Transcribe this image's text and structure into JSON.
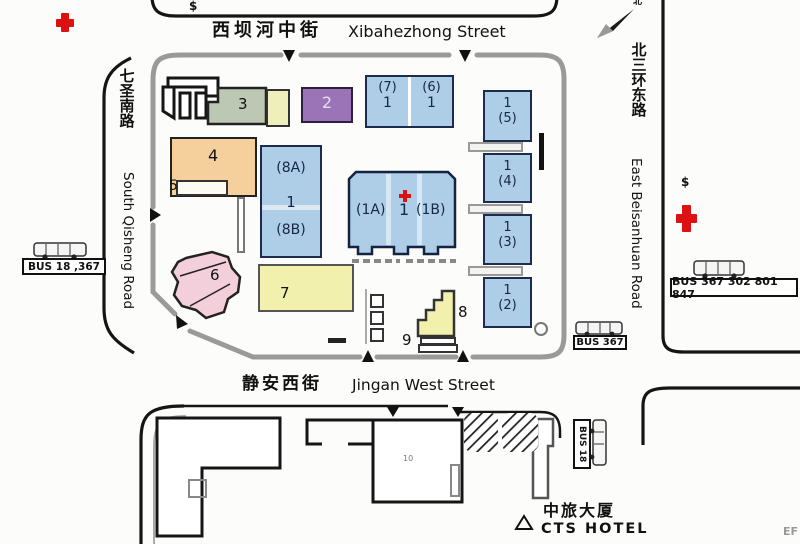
{
  "streets": {
    "north_zh": "西坝河中街",
    "north_en": "Xibahezhong Street",
    "south_zh": "静安西街",
    "south_en": "Jingan West Street",
    "west_zh": "七圣南路",
    "west_en": "South Qisheng Road",
    "east_zh": "北三环东路",
    "east_en": "East Beisanhuan Road"
  },
  "compass": {
    "north": "北"
  },
  "symbols": {
    "bank_top": "$",
    "bank_right": "$",
    "corner_mark": "EF"
  },
  "buildings": {
    "b1": {
      "left": "(1A)",
      "center": "1",
      "right": "(1B)"
    },
    "b2": "2",
    "b3": "3",
    "b4": "4",
    "b5": "5",
    "b6": "6",
    "b7": "7",
    "b8": "8",
    "b9": "9",
    "b10": "10",
    "b76": {
      "left_top": "(7)",
      "left_num": "1",
      "right_top": "(6)",
      "right_num": "1"
    },
    "b8ab": {
      "top": "(8A)",
      "num": "1",
      "bottom": "(8B)"
    },
    "t5": {
      "num": "1",
      "sub": "(5)"
    },
    "t4": {
      "num": "1",
      "sub": "(4)"
    },
    "t3": {
      "num": "1",
      "sub": "(3)"
    },
    "t2": {
      "num": "1",
      "sub": "(2)"
    }
  },
  "bus": {
    "west": "BUS 18 ,367",
    "east": "BUS 367 302 801 847",
    "inner": "BUS 367",
    "south": "BUS 18"
  },
  "hotel": {
    "zh": "中旅大厦",
    "en": "CTS HOTEL"
  },
  "colors": {
    "blue": "#aecde6",
    "purple": "#9b74b8",
    "green": "#bcc7b4",
    "orange": "#f6d09c",
    "pink": "#f3cedb",
    "yellow": "#f1f1ad",
    "cream": "#efefbc",
    "red_cross": "#dd1111",
    "road": "#151515",
    "border_gray": "#9a9a9a"
  }
}
